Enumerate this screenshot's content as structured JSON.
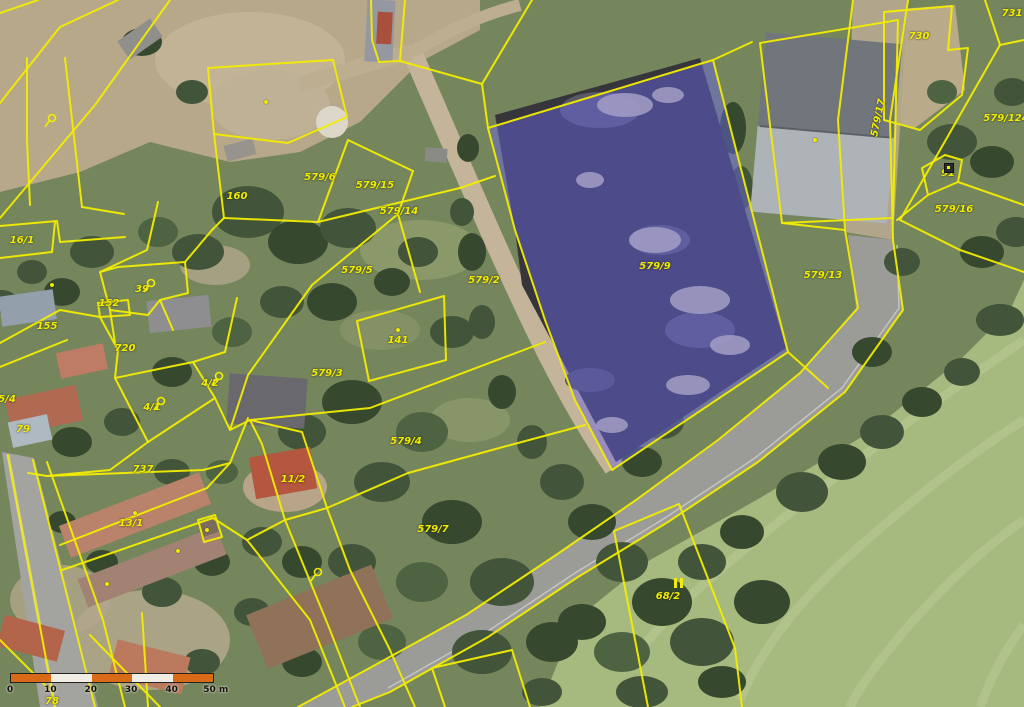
{
  "map": {
    "description": "aerial cadastral parcel map",
    "line_color": "#f2ec00",
    "label_color": "#f2ec00",
    "selected_parcel": {
      "label": "579/9",
      "highlight_fill": "rgba(104,99,225,0.47)"
    },
    "labels": [
      {
        "text": "160",
        "x": 237,
        "y": 197
      },
      {
        "text": "16/1",
        "x": 22,
        "y": 241
      },
      {
        "text": "39",
        "x": 142,
        "y": 290
      },
      {
        "text": "152",
        "x": 109,
        "y": 304
      },
      {
        "text": "155",
        "x": 47,
        "y": 327
      },
      {
        "text": "720",
        "x": 125,
        "y": 349
      },
      {
        "text": "5/4",
        "x": 7,
        "y": 400
      },
      {
        "text": "4/2",
        "x": 210,
        "y": 384
      },
      {
        "text": "4/1",
        "x": 152,
        "y": 408
      },
      {
        "text": "79",
        "x": 23,
        "y": 430
      },
      {
        "text": "737",
        "x": 143,
        "y": 470
      },
      {
        "text": "13/1",
        "x": 131,
        "y": 524
      },
      {
        "text": "78",
        "x": 52,
        "y": 702
      },
      {
        "text": "579/6",
        "x": 320,
        "y": 178
      },
      {
        "text": "579/15",
        "x": 375,
        "y": 186
      },
      {
        "text": "579/14",
        "x": 399,
        "y": 212
      },
      {
        "text": "579/5",
        "x": 357,
        "y": 271
      },
      {
        "text": "579/2",
        "x": 484,
        "y": 281
      },
      {
        "text": "141",
        "x": 398,
        "y": 341
      },
      {
        "text": "579/3",
        "x": 327,
        "y": 374
      },
      {
        "text": "579/4",
        "x": 406,
        "y": 442
      },
      {
        "text": "11/2",
        "x": 293,
        "y": 480
      },
      {
        "text": "579/7",
        "x": 433,
        "y": 530
      },
      {
        "text": "579/9",
        "x": 655,
        "y": 267,
        "selected": true
      },
      {
        "text": "579/13",
        "x": 823,
        "y": 276
      },
      {
        "text": "579/17",
        "x": 879,
        "y": 118,
        "rotate": -78
      },
      {
        "text": "730",
        "x": 919,
        "y": 37
      },
      {
        "text": "731",
        "x": 1012,
        "y": 14
      },
      {
        "text": "579/124",
        "x": 1006,
        "y": 119
      },
      {
        "text": "91",
        "x": 948,
        "y": 174
      },
      {
        "text": "579/16",
        "x": 954,
        "y": 210
      },
      {
        "text": "68/2",
        "x": 668,
        "y": 597
      }
    ],
    "symbols": [
      {
        "type": "lasso",
        "x": 43,
        "y": 112
      },
      {
        "type": "lasso",
        "x": 142,
        "y": 277
      },
      {
        "type": "lasso",
        "x": 210,
        "y": 370
      },
      {
        "type": "lasso",
        "x": 152,
        "y": 395
      },
      {
        "type": "lasso",
        "x": 309,
        "y": 566
      },
      {
        "type": "double-bar",
        "x": 673,
        "y": 577
      },
      {
        "type": "square",
        "x": 944,
        "y": 163
      }
    ],
    "dots": [
      [
        266,
        102
      ],
      [
        398,
        330
      ],
      [
        135,
        513
      ],
      [
        207,
        530
      ],
      [
        107,
        584
      ],
      [
        815,
        140
      ],
      [
        52,
        285
      ],
      [
        178,
        551
      ]
    ]
  },
  "scalebar": {
    "unit_labels": [
      "0",
      "10",
      "20",
      "30",
      "40",
      "50 m"
    ],
    "segments": [
      "#d96a17",
      "#f2ede4",
      "#d96a17",
      "#f2ede4",
      "#d96a17"
    ]
  }
}
